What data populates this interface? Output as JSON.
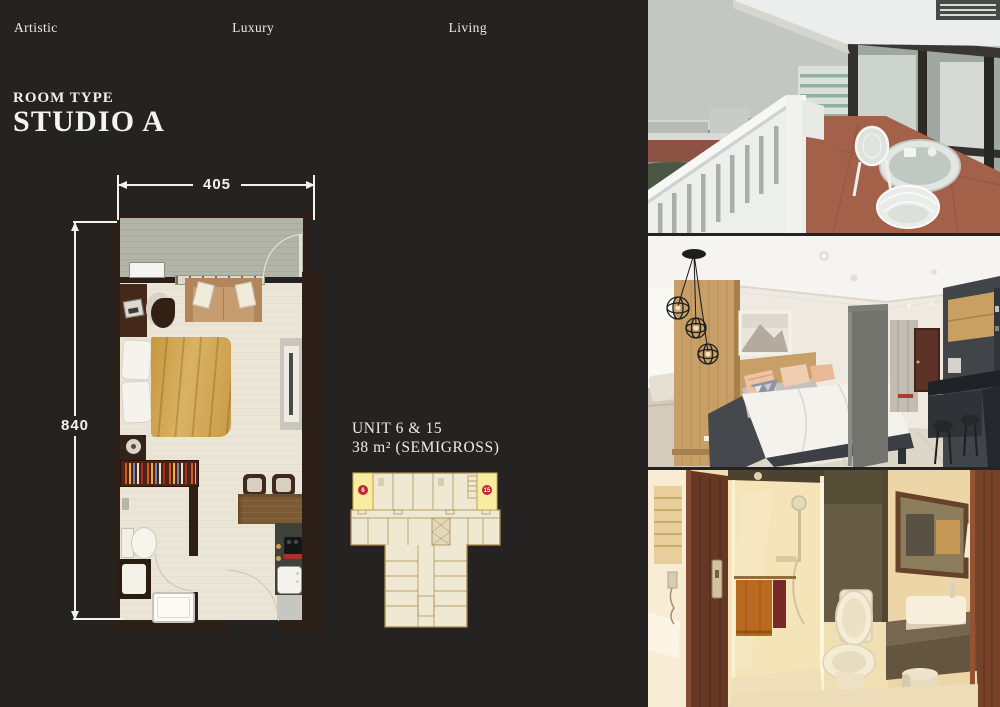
{
  "page": {
    "background": "#252322",
    "text_color": "#f1efea"
  },
  "header": {
    "words": [
      "Artistic",
      "Luxury",
      "Living"
    ]
  },
  "room_type": {
    "eyebrow": "ROOM TYPE",
    "name": "STUDIO A"
  },
  "floor_plan": {
    "width_dim": "405",
    "height_dim": "840",
    "colors": {
      "wall": "#2b1f17",
      "floor": "#ebe5d7",
      "balcony_floor": "#b1b4a7",
      "bed_cover": "#d2a455",
      "sofa": "#c59d71",
      "dining_wood": "#7c5a34",
      "kitchen_counter": "#3e423a"
    }
  },
  "unit_info": {
    "units": "UNIT 6 & 15",
    "area": "38 m² (SEMIGROSS)"
  },
  "key_plan": {
    "badges": [
      "6",
      "15"
    ],
    "outline": "#a8894b",
    "fill": "#efe8d2",
    "highlight": "#f7ec9f",
    "badge_red": "#c1272d"
  },
  "photos": [
    {
      "subject": "balcony-city-view"
    },
    {
      "subject": "bedroom"
    },
    {
      "subject": "bathroom"
    }
  ]
}
